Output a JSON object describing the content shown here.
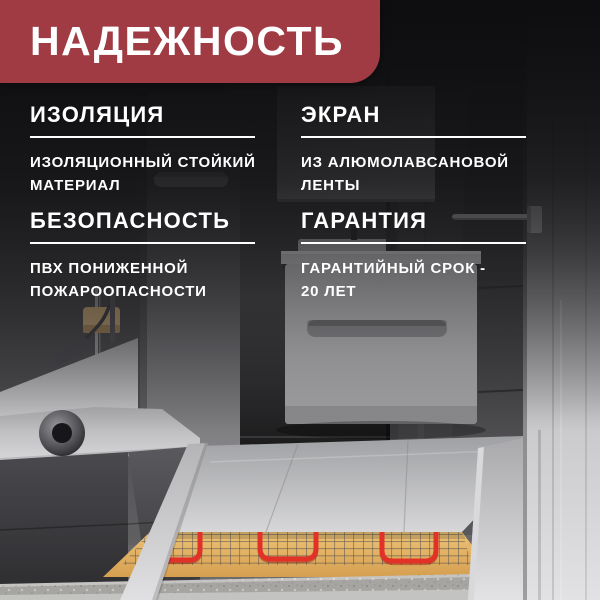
{
  "banner": {
    "title": "НАДЕЖНОСТЬ"
  },
  "features": [
    {
      "title": "ИЗОЛЯЦИЯ",
      "line1": "ИЗОЛЯЦИОННЫЙ СТОЙКИЙ",
      "line2": "МАТЕРИАЛ"
    },
    {
      "title": "ЭКРАН",
      "line1": "ИЗ АЛЮМОЛАВСАНОВОЙ",
      "line2": "ЛЕНТЫ"
    },
    {
      "title": "БЕЗОПАСНОСТЬ",
      "line1": "ПВХ ПОНИЖЕННОЙ",
      "line2": "ПОЖАРООПАСНОСТИ"
    },
    {
      "title": "ГАРАНТИЯ",
      "line1": "ГАРАНТИЙНЫЙ СРОК -",
      "line2": "20 ЛЕТ"
    }
  ],
  "colors": {
    "banner_red": "#a03a43",
    "text_white": "#ffffff",
    "cable_red": "#e23228",
    "mat_sand": "#e2b261",
    "concrete_gray": "#a7a5a2"
  },
  "scene": {
    "alt": "Gray tiled bathroom with white bathtub, tall cabinet, mirror, floating vanity, towel rail and cut-away floor showing an electric heating mat with red cable over concrete"
  }
}
